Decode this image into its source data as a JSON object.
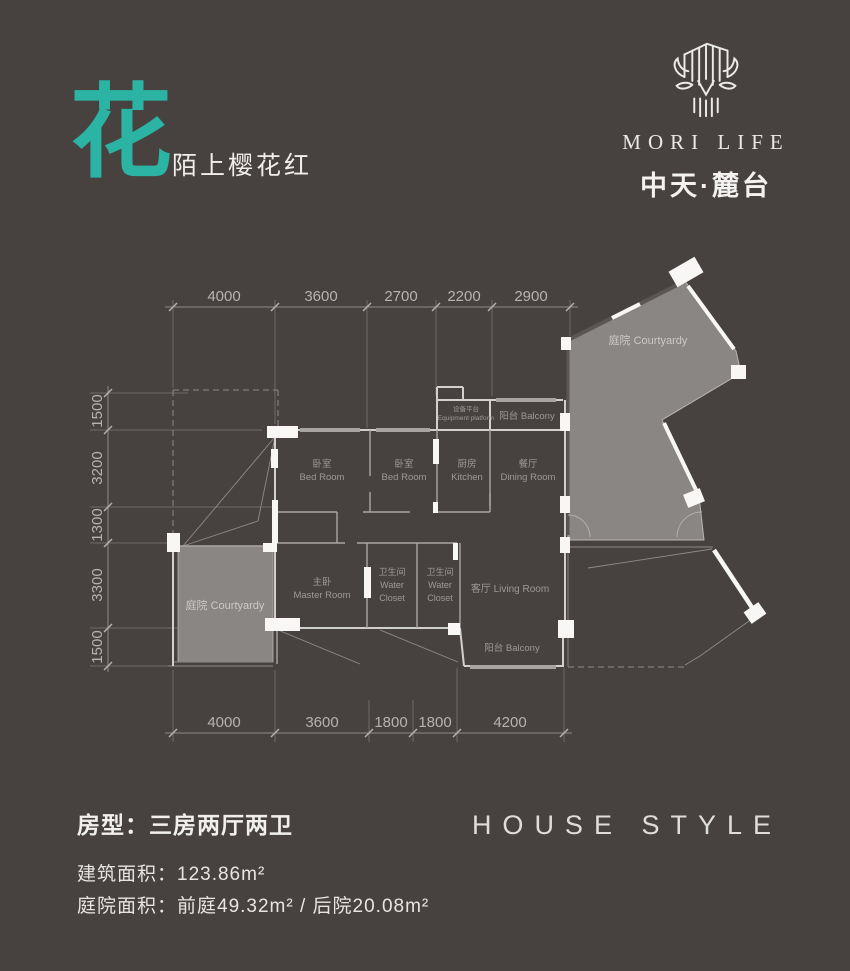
{
  "colors": {
    "background": "#474240",
    "accent_teal": "#2bb4a4",
    "courtyard_fill": "#8a8683"
  },
  "header": {
    "title_char": "花",
    "subtitle": "陌上樱花红"
  },
  "brand": {
    "logo_icon": "deer-tree-mark",
    "name_en": "MORI LIFE",
    "name_cn": "中天·麓台"
  },
  "floor_plan": {
    "dims_top": [
      "4000",
      "3600",
      "2700",
      "2200",
      "2900"
    ],
    "dims_left": [
      "1500",
      "3200",
      "1300",
      "3300",
      "1500"
    ],
    "dims_bottom": [
      "4000",
      "3600",
      "1800",
      "1800",
      "4200"
    ],
    "labels": {
      "bedroom1_cn": "卧室",
      "bedroom1_en": "Bed Room",
      "bedroom2_cn": "卧室",
      "bedroom2_en": "Bed Room",
      "kitchen_cn": "厨房",
      "kitchen_en": "Kitchen",
      "dining_cn": "餐厅",
      "dining_en": "Dining Room",
      "master_cn": "主卧",
      "master_en": "Master Room",
      "wc1_cn": "卫生间",
      "wc1_en1": "Water",
      "wc1_en2": "Closet",
      "wc2_cn": "卫生间",
      "wc2_en1": "Water",
      "wc2_en2": "Closet",
      "living": "客厅 Living Room",
      "balcony_top": "阳台 Balcony",
      "balcony_bottom": "阳台 Balcony",
      "equipment_cn": "设备平台",
      "equipment_en": "Equipment platform",
      "courtyard_front": "庭院 Courtyardy",
      "courtyard_back": "庭院 Courtyardy"
    }
  },
  "footer": {
    "house_type": "房型：三房两厅两卫",
    "house_style": "HOUSE STYLE",
    "area_build_label": "建筑面积：",
    "area_build_value": "123.86m²",
    "area_yard_label": "庭院面积：",
    "area_yard_value": "前庭49.32m² / 后院20.08m²"
  }
}
